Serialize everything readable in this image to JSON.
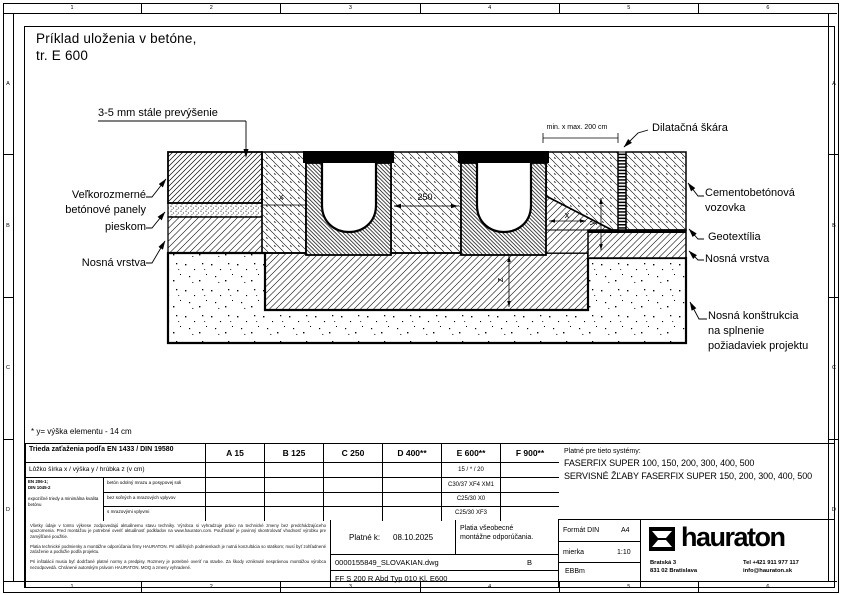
{
  "frame": {
    "cols": [
      "1",
      "2",
      "3",
      "4",
      "5",
      "6"
    ],
    "rows": [
      "A",
      "B",
      "C",
      "D"
    ]
  },
  "title": {
    "line1": "Príklad uloženia v betóne,",
    "line2": "tr. E 600"
  },
  "drawing": {
    "labels": {
      "overhang": "3-5 mm stále prevýšenie",
      "panels1": "Veľkorozmerné",
      "panels2": "betónové panely",
      "sand": "pieskom",
      "base_left": "Nosná vrstva",
      "dilatation": "Dilatačná škára",
      "minmax": "min. x max. 200 cm",
      "pavement1": "Cementobetónová",
      "pavement2": "vozovka",
      "geotextile": "Geotextília",
      "base_right": "Nosná vrstva",
      "structure1": "Nosná konštrukcia",
      "structure2": "na splnenie",
      "structure3": "požiadaviek projektu"
    },
    "dims": {
      "channel": "250",
      "x_left": "x",
      "x_right": "x",
      "y": "y",
      "z": "z"
    }
  },
  "footnote": "* y= výška elementu - 14 cm",
  "load_table": {
    "class_header": "Trieda zaťaženia podľa EN 1433 / DIN 19580",
    "classes": [
      "A 15",
      "B 125",
      "C 250",
      "D 400**",
      "E 600**",
      "F 900**"
    ],
    "bedding_label": "Lôžko šírka x / výška y / hrúbka z (v cm)",
    "bedding_e600": "15 / * / 20",
    "standard1": "EN 206-1;",
    "standard2": "DIN 1045-2",
    "standard_note": "expozičné triedy a minimálna kvalita betónu",
    "rows": [
      {
        "label": "betón odolný mrazu a posypovej soli",
        "e600": "C30/37 XF4 XM1"
      },
      {
        "label": "bez soľných a mrazových vplyvov",
        "e600": "C25/30 X0"
      },
      {
        "label": "s mrazovými vplyvmi",
        "e600": "C25/30 XF3"
      }
    ]
  },
  "systems": {
    "title": "Platné pre tieto systémy:",
    "line1": "FASERFIX SUPER 100, 150, 200, 300, 400, 500",
    "line2": "SERVISNÉ ŽĽABY FASERFIX SUPER 150, 200, 300, 400, 500"
  },
  "titleblock": {
    "disclaimer1": "Všetky údaje v tomto výkrese zodpovedajú aktuálnemu stavu techniky. Výrobca si vyhradzuje právo na technické zmeny bez predchádzajúceho upozornenia. Pred montážou je potrebné overiť aktuálnosť podkladov na www.hauraton.com. Používateľ je povinný skontrolovať vhodnosť výrobku pre zamýšľané použitie.",
    "disclaimer2": "Platia technické podmienky a montážne odporúčania firmy HAURATON. Pri odlišných podmienkach je nutná konzultácia so statikom; musí byť zohľadnené zaťaženie a podložie podľa projektu.",
    "disclaimer3": "Pri inštalácii musia byť dodržané platné normy a predpisy. Rozmery je potrebné overiť na stavbe. Za škody vzniknuté nesprávnou montážou výrobca nezodpovedá. Chránené autorským právom HAURATON. MOQ a zmeny vyhradené.",
    "valid_label": "Platné k:",
    "valid_date": "08.10.2025",
    "note1": "Platia všeobecné",
    "note2": "montážne odporúčania.",
    "file": "0000155849_SLOVAKIAN.dwg",
    "revision": "B",
    "product": "FF  S 200 R Abd Typ 010 Kl. E600",
    "format_label": "Formát DIN",
    "format_value": "A4",
    "scale_label": "mierka",
    "scale_value": "1:10",
    "author": "EBBm",
    "brand": "hauraton",
    "addr1": "Bratská 3",
    "addr2": "831 02 Bratislava",
    "tel": "Tel +421 911 977 117",
    "email": "info@hauraton.sk"
  }
}
